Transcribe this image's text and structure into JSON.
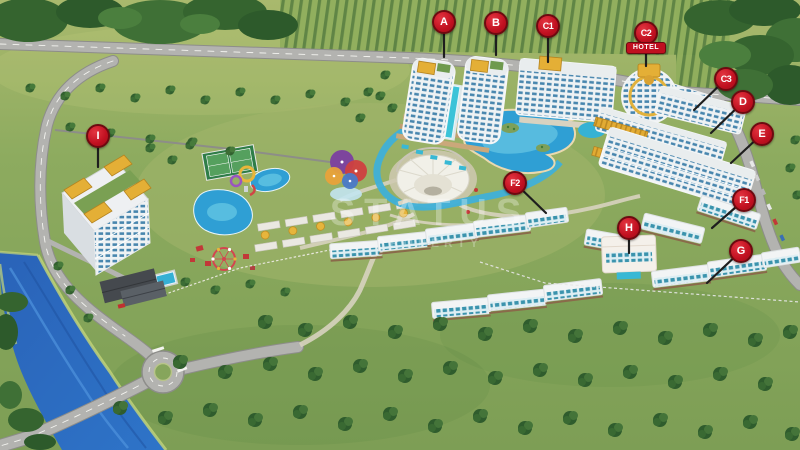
{
  "watermark": {
    "line1": "STATUS",
    "line2": "PROPERTY"
  },
  "hotel_badge_label": "HOTEL",
  "markers": [
    {
      "letter": "A"
    },
    {
      "letter": "B"
    },
    {
      "letter": "C1"
    },
    {
      "letter": "C2"
    },
    {
      "letter": "C3"
    },
    {
      "letter": "D"
    },
    {
      "letter": "E"
    },
    {
      "letter": "F1"
    },
    {
      "letter": "F2"
    },
    {
      "letter": "G"
    },
    {
      "letter": "H"
    },
    {
      "letter": "I"
    }
  ],
  "colors": {
    "marker_red": "#c01020",
    "marker_border": "#6d0a10",
    "pool_turquoise": "#38b8d4",
    "river_blue": "#2a63b8",
    "grass_green": "#7d9c54",
    "gold_accent": "#e2ab33"
  }
}
